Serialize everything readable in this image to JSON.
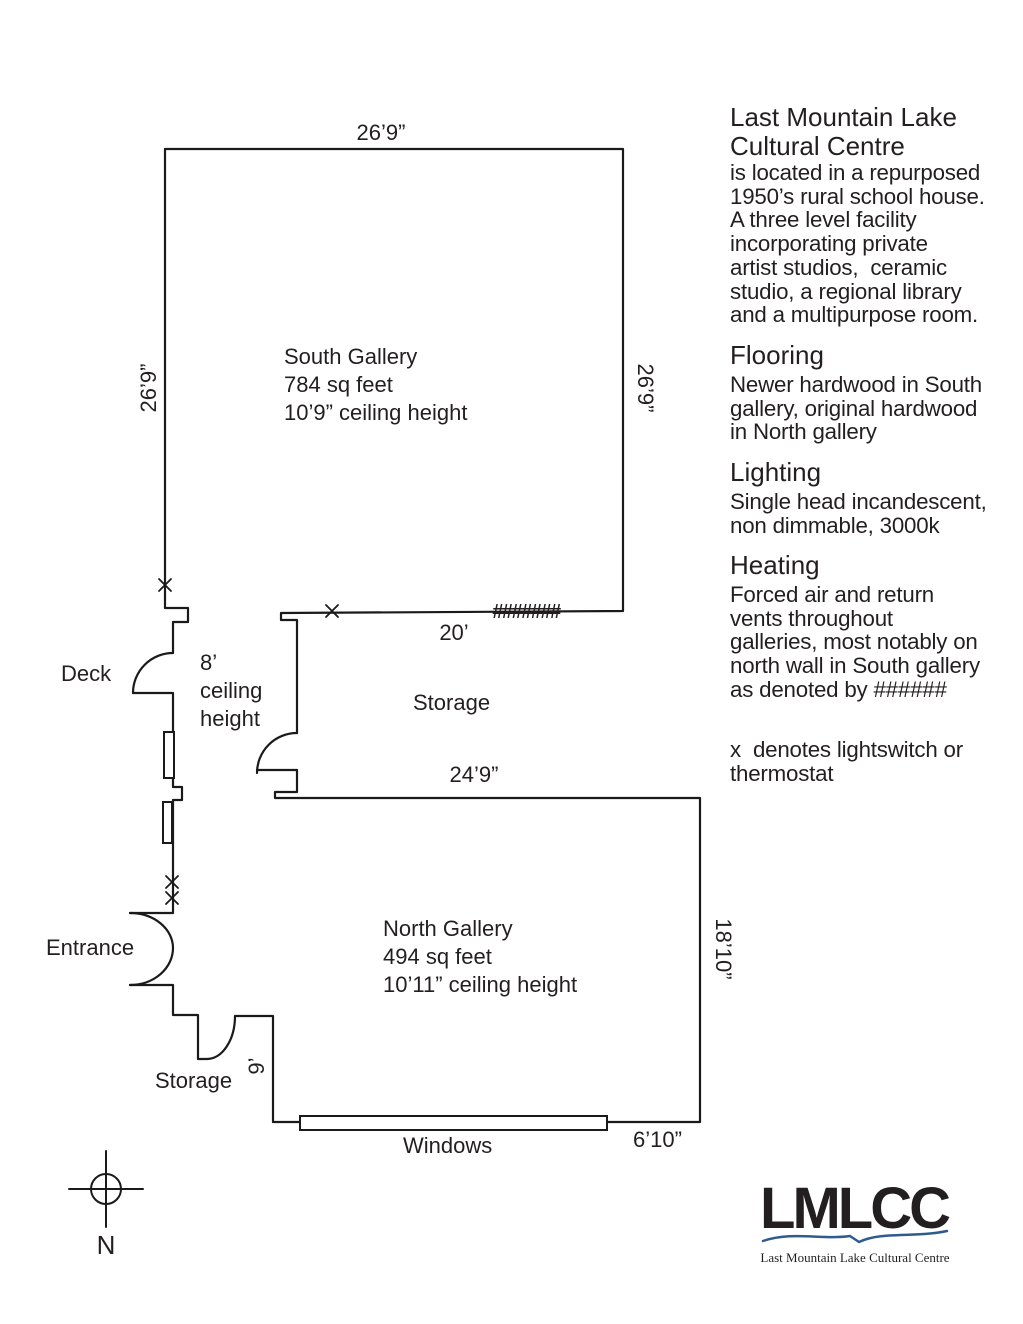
{
  "plan": {
    "dimensions": {
      "south_top": "26’9”",
      "south_left": "26’9”",
      "south_right": "26’9”",
      "storage_width": "20’",
      "north_top": "24’9”",
      "north_right": "18’10”",
      "storage_depth": "9’",
      "windows": "6’10”"
    },
    "rooms": {
      "south_gallery": {
        "lines": [
          "South Gallery",
          "784 sq feet",
          "10’9” ceiling height"
        ]
      },
      "north_gallery": {
        "lines": [
          "North Gallery",
          "494 sq feet",
          "10’11” ceiling height"
        ]
      },
      "corridor": {
        "lines": [
          "8’",
          "ceiling",
          "height"
        ]
      },
      "storage_mid": "Storage",
      "storage_bottom": "Storage",
      "deck": "Deck",
      "entrance": "Entrance",
      "windows_label": "Windows"
    },
    "hash_marks": "#######",
    "compass_north": "N"
  },
  "info": {
    "title": "Last Mountain Lake\nCultural Centre",
    "intro": "is located in a repurposed\n1950’s rural school house.\nA three level facility\nincorporating private\nartist studios,  ceramic\nstudio, a regional library\nand a multipurpose room.",
    "flooring": {
      "heading": "Flooring",
      "body": "Newer hardwood in South\ngallery, original hardwood\nin North gallery"
    },
    "lighting": {
      "heading": "Lighting",
      "body": "Single head incandescent,\nnon dimmable, 3000k"
    },
    "heating": {
      "heading": "Heating",
      "body": "Forced air and return\nvents throughout\ngalleries, most notably on\nnorth wall in South gallery\nas denoted by ######"
    },
    "legend": "x  denotes lightswitch or\nthermostat"
  },
  "logo": {
    "acronym": "LMLCC",
    "caption": "Last Mountain Lake Cultural Centre"
  },
  "colors": {
    "wall_line": "#1a1a1a",
    "text": "#231f20",
    "logo_green": "#8fac52",
    "logo_blue": "#2f5b8e"
  }
}
